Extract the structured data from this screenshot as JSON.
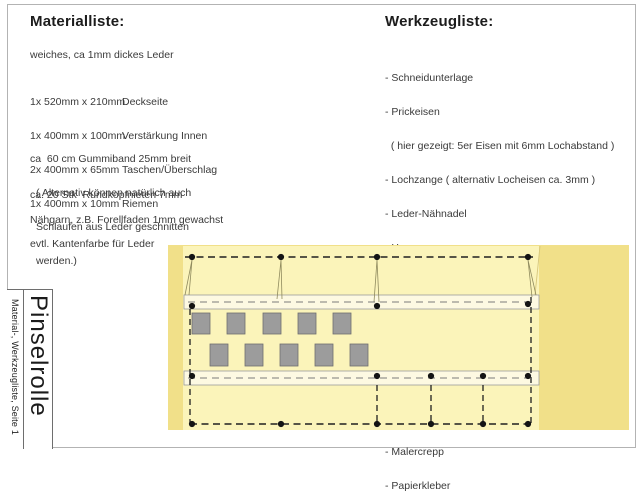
{
  "material": {
    "title": "Materialliste:",
    "intro": "weiches, ca 1mm dickes Leder",
    "items": [
      {
        "size": "1x 520mm x 210mm",
        "name": "Deckseite"
      },
      {
        "size": "1x 400mm x 100mm",
        "name": "Verstärkung Innen"
      },
      {
        "size": "2x 400mm x 65mm",
        "name": "Taschen/Überschlag"
      },
      {
        "size": "1x 400mm x 10mm",
        "name": "Riemen"
      }
    ],
    "note_gummiband": {
      "line1": "ca  60 cm Gummiband 25mm breit",
      "line2": "( Alternativ können natürlich auch",
      "line3": "Schlaufen aus Leder geschnitten",
      "line4": "werden.)"
    },
    "note_nieten": "ca. 20 Stk  Rundkopfnieten 7mm",
    "note_garn": "Nähgarn, z.B. Forellfaden 1mm gewachst",
    "note_kantenfarbe": "evtl. Kantenfarbe für Leder"
  },
  "tools": {
    "title": "Werkzeugliste:",
    "items": [
      "- Schneidunterlage",
      "- Prickeisen",
      "  ( hier gezeigt: 5er Eisen mit 6mm Lochabstand )",
      "- Lochzange ( alternativ Locheisen ca. 3mm )",
      "- Leder-Nähnadel",
      "- Hammer",
      "- Metallineal",
      "- Cuttermesser",
      "- Stechahle",
      "- Lederleim / kleber",
      "- Nietensetzwerkzeug ( ein Hammer reicht jedoch )",
      "- Malercrepp",
      "- Papierkleber"
    ]
  },
  "titleblock": {
    "project": "Pinselrolle",
    "subtitle": "Material-, Werkzeugliste, Seite 1"
  },
  "diagram": {
    "cover_fill": "#f1e089",
    "inner_fill": "#fbf4ba",
    "strip_fill": "#fdf9e2",
    "slot_fill": "#9c9c9c",
    "rivet_color": "#141414",
    "dash_color": "#1f1f1f",
    "strip_dash_color": "#7a7a7a",
    "loop_line_color": "#8f8a5e"
  }
}
